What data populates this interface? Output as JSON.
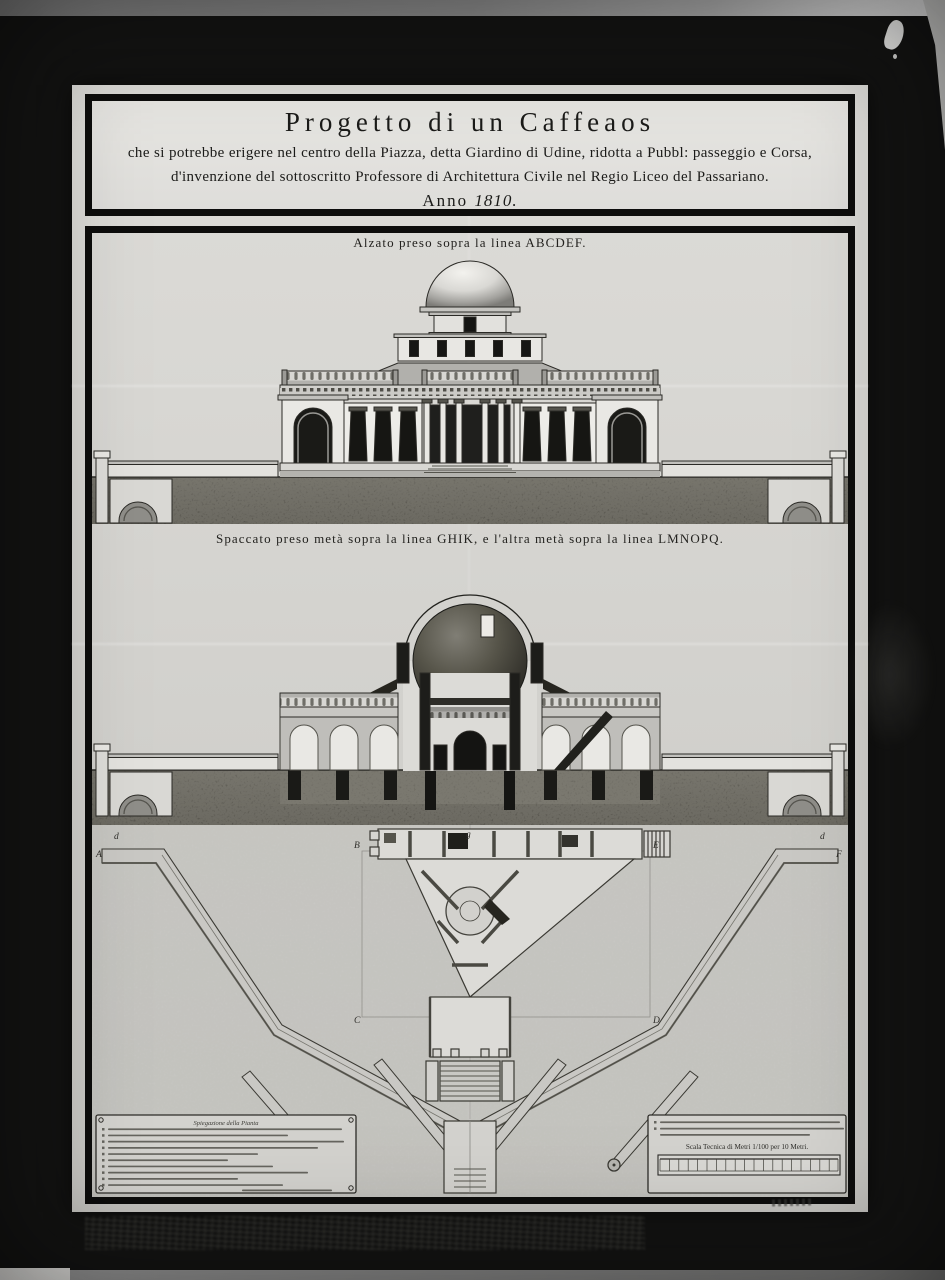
{
  "colors": {
    "mount_black": "#141413",
    "paper": "#d7d6d2",
    "frame_black": "#0d0d0c",
    "ink": "#1b1b19",
    "ground_dark": "#46443c"
  },
  "title_block": {
    "line1": "Progetto di un Caffeaos",
    "line2": "che si potrebbe erigere nel centro della Piazza, detta Giardino di Udine, ridotta a Pubbl: passeggio e Corsa,",
    "line3": "d'invenzione del sottoscritto Professore di Architettura Civile nel Regio Liceo del Passariano.",
    "anno_label": "Anno",
    "anno_year": "1810."
  },
  "figures": {
    "elevation_caption": "Alzato preso sopra la linea ABCDEF.",
    "section_caption": "Spaccato preso metà sopra la linea GHIK, e l'altra metà sopra la linea LMNOPQ."
  },
  "plan": {
    "letters": [
      "d",
      "A",
      "B",
      "g",
      "E",
      "F",
      "d",
      "C",
      "D"
    ],
    "legend_heading": "Spiegazione della Pianta",
    "scale_label": "Scala Tecnica di Metri 1/100 per 10 Metri."
  }
}
